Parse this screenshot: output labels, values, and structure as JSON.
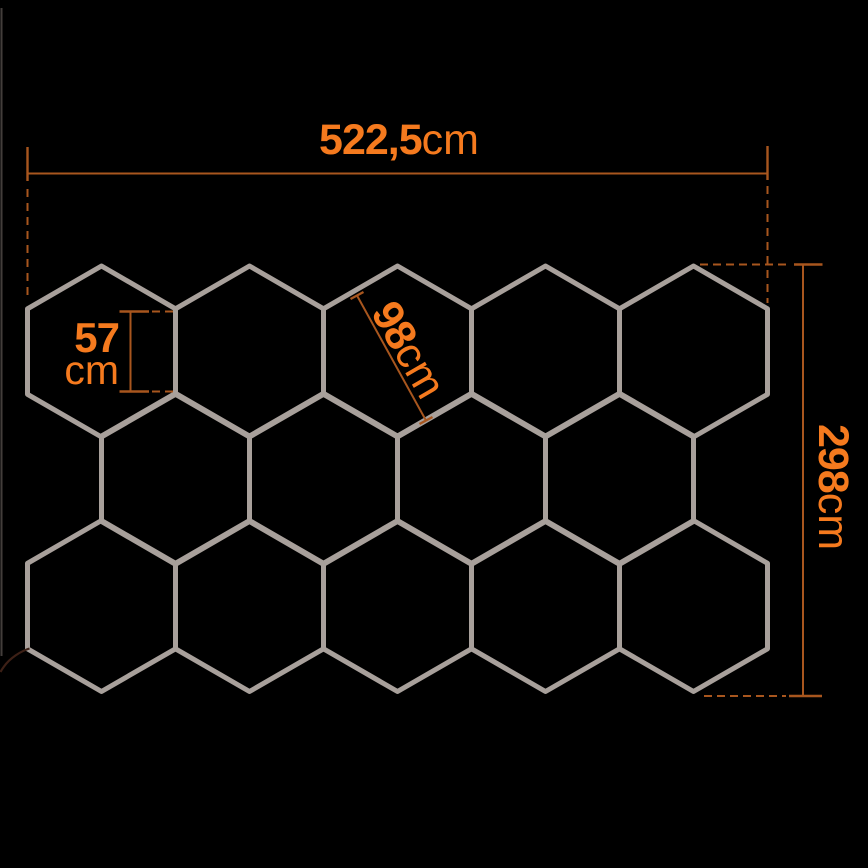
{
  "diagram": {
    "title": "hexagon-led-panel-dimension-diagram",
    "colors": {
      "background": "#000000",
      "hexagon_stroke": "#a8a09b",
      "accent_text": "#f57a1e",
      "dimension_line": "#a8561e",
      "power_cord": "#3d2016",
      "edge_line": "#5a534f"
    },
    "grid": {
      "hexagon_count": 14,
      "hex_side_px": 85.5,
      "rows": [
        {
          "center_y": 351.5,
          "centers_x": [
            101.5,
            249.5,
            397.5,
            545.5,
            693.5
          ]
        },
        {
          "center_y": 478.75,
          "centers_x": [
            175.5,
            323.5,
            471.5,
            619.5
          ]
        },
        {
          "center_y": 606.0,
          "centers_x": [
            101.5,
            249.5,
            397.5,
            545.5,
            693.5
          ]
        }
      ]
    },
    "dimensions": {
      "width": {
        "value": "522,5",
        "unit": "cm"
      },
      "height": {
        "value": "298",
        "unit": "cm"
      },
      "hex_width": {
        "value": "98",
        "unit": "cm"
      },
      "hex_side_value": "57",
      "hex_side_unit": "cm"
    }
  }
}
